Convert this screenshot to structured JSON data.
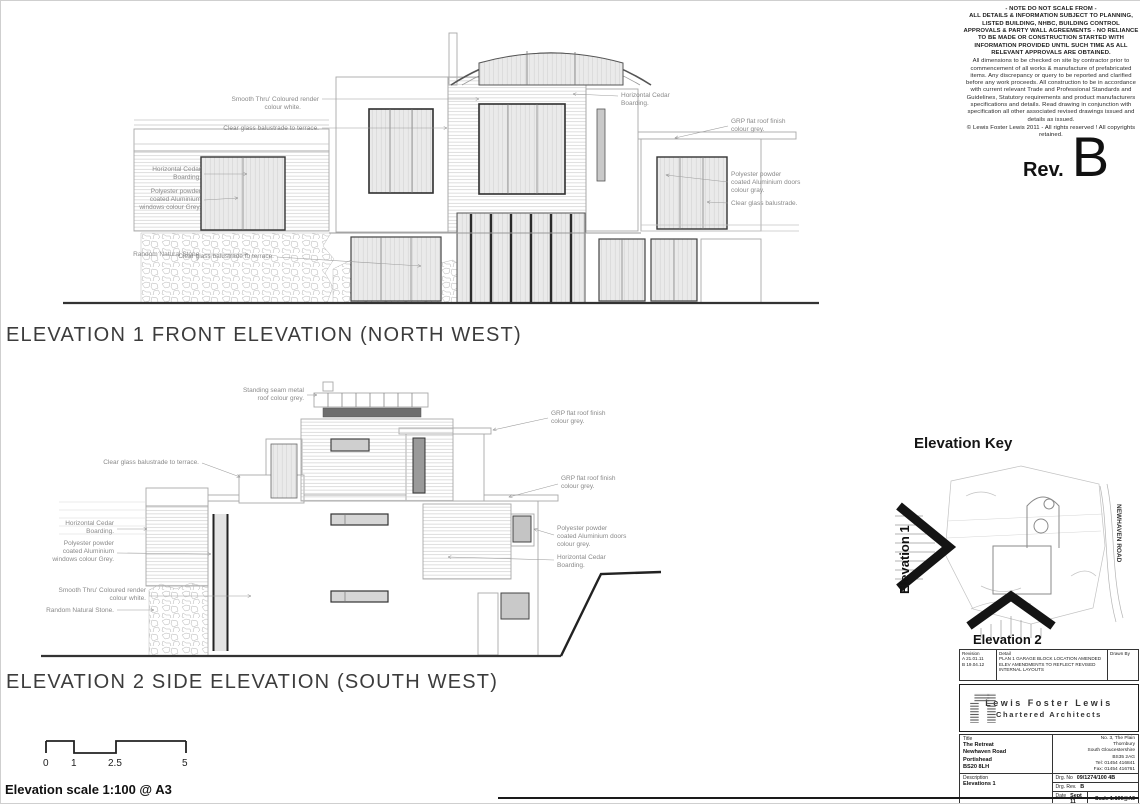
{
  "disclaimer": {
    "note": "- NOTE DO NOT SCALE FROM -",
    "intro": "ALL DETAILS & INFORMATION SUBJECT TO PLANNING, LISTED BUILDING, NHBC, BUILDING CONTROL APPROVALS & PARTY WALL AGREEMENTS - ",
    "warning": "NO RELIANCE TO BE MADE OR CONSTRUCTION STARTED WITH INFORMATION PROVIDED UNTIL SUCH TIME AS ALL RELEVANT APPROVALS ARE OBTAINED.",
    "body": "All dimensions to be checked on site by contractor prior to commencement of all works & manufacture of prefabricated items. Any discrepancy or query to be reported and clarified before any work proceeds. All construction to be in accordance with current relevant Trade and Professional Standards and Guidelines, Statutory requirements and product manufacturers specifications and details. Read drawing in conjunction with specification all other associated revised drawings issued and details as issued.",
    "copyright": "© Lewis Foster Lewis 2011 - All rights reserved ! All copyrights retained."
  },
  "rev": {
    "label": "Rev.",
    "value": "B"
  },
  "e1": {
    "title": "ELEVATION 1 FRONT ELEVATION (NORTH WEST)",
    "labels": {
      "render": [
        "Smooth Thru' Coloured render",
        "colour white."
      ],
      "balustrade_top": "Clear glass balustrade to terrace.",
      "cedar": [
        "Horizontal Cedar",
        "Boarding."
      ],
      "windows": [
        "Polyester powder",
        "coated Aluminium",
        "windows colour Grey."
      ],
      "stone": "Random Natural Stone.",
      "balustrade_low": "Clear glass balustrade to terrace.",
      "cedar_r": [
        "Horizontal Cedar",
        "Boarding."
      ],
      "grp": [
        "GRP flat roof finish",
        "colour grey."
      ],
      "doors": [
        "Polyester powder",
        "coated Aluminium doors",
        "colour gray."
      ],
      "balustrade_r": "Clear glass balustrade."
    }
  },
  "e2": {
    "title": "ELEVATION 2 SIDE ELEVATION (SOUTH WEST)",
    "labels": {
      "seam": [
        "Standing seam metal",
        "roof colour grey."
      ],
      "balustrade": "Clear glass balustrade to terrace.",
      "cedar": [
        "Horizontal Cedar",
        "Boarding."
      ],
      "windows": [
        "Polyester powder",
        "coated Aluminium",
        "windows colour Grey."
      ],
      "render": [
        "Smooth Thru' Coloured render",
        "colour white."
      ],
      "stone": "Random Natural Stone.",
      "grp1": [
        "GRP flat roof finish",
        "colour grey."
      ],
      "grp2": [
        "GRP flat roof finish",
        "colour grey."
      ],
      "doors": [
        "Polyester powder",
        "coated Aluminium doors",
        "colour grey."
      ],
      "cedar_r": [
        "Horizontal Cedar",
        "Boarding."
      ]
    }
  },
  "scalebar": {
    "ticks": [
      "0",
      "1",
      "2.5",
      "5"
    ],
    "note": "Elevation scale 1:100 @ A3"
  },
  "key": {
    "title": "Elevation Key",
    "e1": "Elevation 1",
    "e2": "Elevation 2",
    "road": "NEWHAVEN ROAD"
  },
  "tb": {
    "rev_table": {
      "h_rev": "Revision",
      "h_detail": "Detail",
      "h_drawn": "Drawn By",
      "rows": [
        {
          "rev": "A 21.01.11",
          "detail": "PLAN 1 GARAGE BLOCK LOCATION AMENDED"
        },
        {
          "rev": "B 19.04.12",
          "detail": "ELEV AMENDMENTS TO REFLECT REVISED INTERNAL LAYOUTS"
        }
      ]
    },
    "firm_name": "Lewis Foster Lewis",
    "firm_sub": "Chartered Architects",
    "title_label": "Title",
    "project": [
      "The Retreat",
      "Newhaven Road",
      "Portishead",
      "BS20 8LH"
    ],
    "office": [
      "No. 3, The Plain",
      "Thornbury",
      "South Gloucestershire",
      "BS35 2AG",
      "Tel: 01454 416841",
      "Fax: 01454 416761"
    ],
    "desc_label": "Description",
    "desc": "Elevations 1",
    "drg_no_label": "Drg. No",
    "drg_no": "09/1274/100 4B",
    "drg_rev_label": "Drg. Rev.",
    "drg_rev": "B",
    "date_label": "Date",
    "date": "Sept 11",
    "scale": "Scale 1:100@A3"
  }
}
